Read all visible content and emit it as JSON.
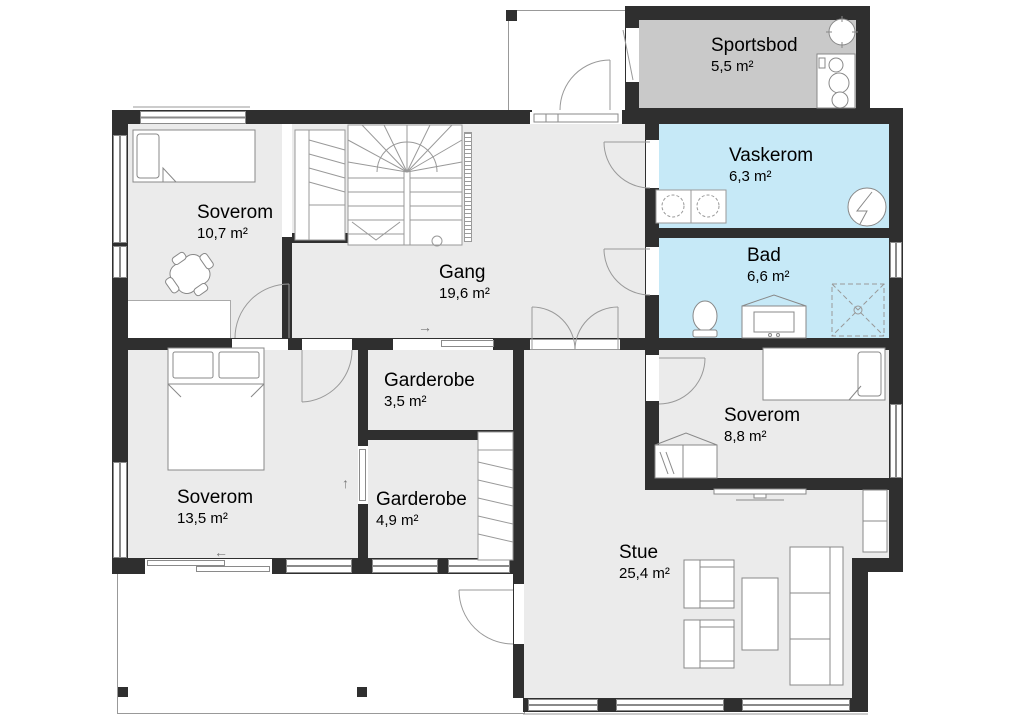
{
  "floorplan": {
    "rooms": [
      {
        "name": "Sportsbod",
        "area": "5,5 m²"
      },
      {
        "name": "Vaskerom",
        "area": "6,3 m²"
      },
      {
        "name": "Bad",
        "area": "6,6 m²"
      },
      {
        "name": "Soverom",
        "area": "10,7 m²"
      },
      {
        "name": "Gang",
        "area": "19,6 m²"
      },
      {
        "name": "Garderobe",
        "area": "3,5 m²"
      },
      {
        "name": "Garderobe",
        "area": "4,9 m²"
      },
      {
        "name": "Soverom",
        "area": "13,5 m²"
      },
      {
        "name": "Soverom",
        "area": "8,8 m²"
      },
      {
        "name": "Stue",
        "area": "25,4 m²"
      }
    ],
    "symbols": {
      "slide_right": "→",
      "slide_left": "←",
      "slide_up": "↑"
    },
    "colors": {
      "wall": "#2f2f2f",
      "floor": "#ebebeb",
      "wet_room": "#c6e9f7",
      "storage": "#c9c9c9",
      "outline": "#8a8a8a"
    }
  }
}
